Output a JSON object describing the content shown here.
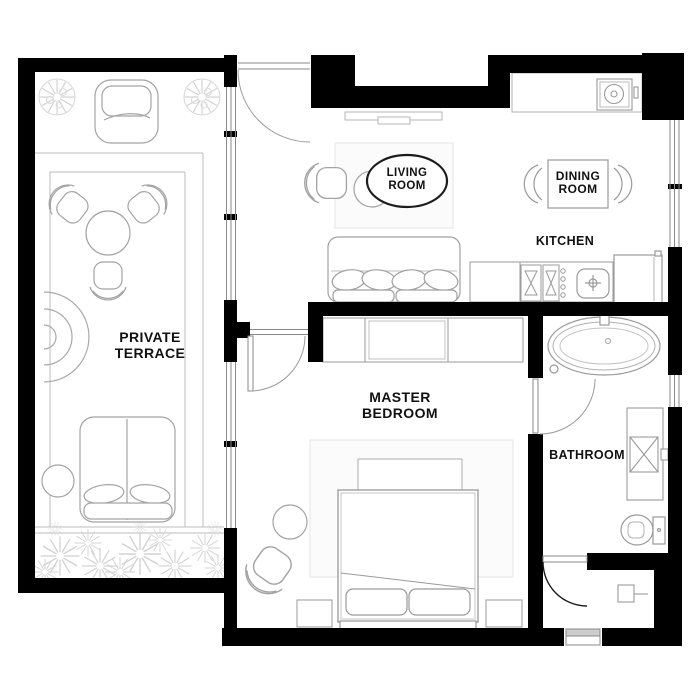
{
  "title": "Apartment floor plan",
  "colors": {
    "wall": "#000000",
    "furniture_line": "#a3a3a3",
    "furniture_line_dark": "#8f8f8f",
    "deck_line": "#bdbdbd",
    "plant_line": "#d2d2d2",
    "rug_fill": "#fbfbfb",
    "rug_line": "#e4e4e4",
    "label_color": "#111111",
    "background": "#ffffff"
  },
  "labels": {
    "private_terrace": {
      "line1": "PRIVATE",
      "line2": "TERRACE"
    },
    "living_room": {
      "line1": "LIVING",
      "line2": "ROOM"
    },
    "dining_room": {
      "line1": "DINING",
      "line2": "ROOM"
    },
    "kitchen": {
      "text": "KITCHEN"
    },
    "master_bedroom": {
      "line1": "MASTER",
      "line2": "BEDROOM"
    },
    "bathroom": {
      "text": "BATHROOM"
    }
  },
  "rooms": [
    {
      "name": "Private Terrace",
      "furniture": [
        "potted-plant",
        "potted-plant",
        "lounge-chair",
        "armchair",
        "armchair",
        "armchair",
        "round-table",
        "round-lounger",
        "daybed",
        "side-table",
        "flower-bed",
        "deck"
      ]
    },
    {
      "name": "Living Room",
      "furniture": [
        "tv-console",
        "armchair",
        "coffee-table",
        "sofa",
        "rug"
      ]
    },
    {
      "name": "Dining Room",
      "furniture": [
        "dining-table",
        "chair",
        "chair"
      ]
    },
    {
      "name": "Kitchen",
      "furniture": [
        "counter",
        "cooktop",
        "sink",
        "refrigerator",
        "washing-machine-counter"
      ]
    },
    {
      "name": "Master Bedroom",
      "furniture": [
        "wardrobe",
        "bed",
        "nightstand",
        "nightstand",
        "bench",
        "armchair",
        "side-table",
        "rug"
      ]
    },
    {
      "name": "Bathroom",
      "furniture": [
        "bathtub",
        "shower",
        "toilet"
      ]
    },
    {
      "name": "Utility Closet",
      "furniture": [
        "water-heater"
      ]
    }
  ]
}
